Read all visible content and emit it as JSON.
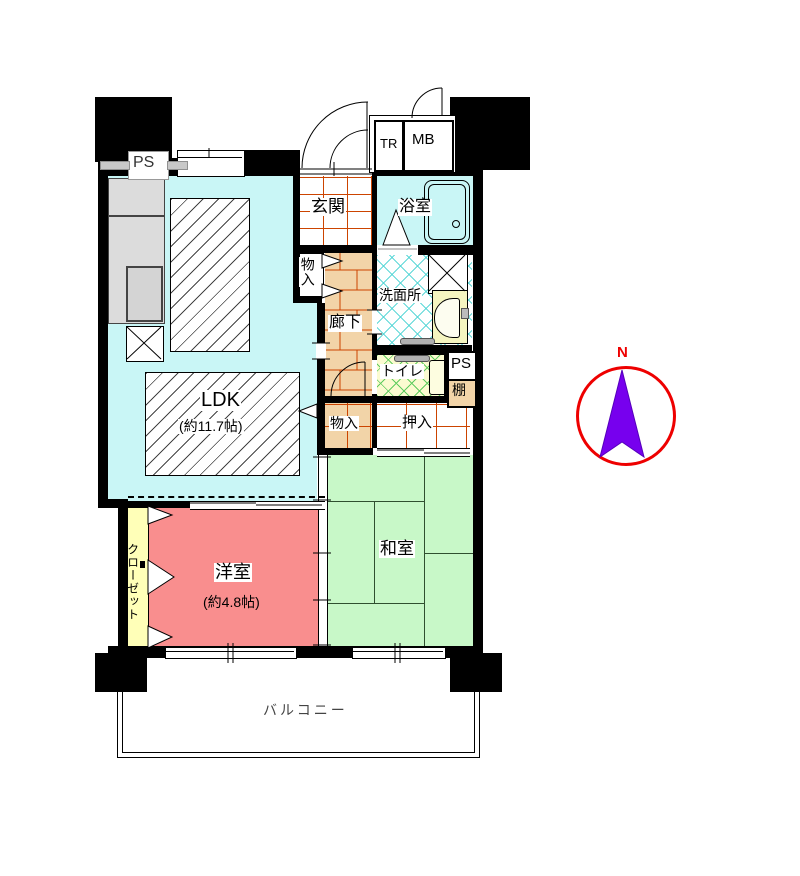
{
  "plan": {
    "rooms": {
      "ldk": {
        "label": "LDK",
        "size": "(約11.7帖)",
        "color": "#C9F6F6"
      },
      "western": {
        "label": "洋室",
        "size": "(約4.8帖)",
        "color": "#F98E8E"
      },
      "japanese": {
        "label": "和室",
        "color": "#C8F8C8"
      },
      "genkan": {
        "label": "玄関",
        "grid_color": "#CC4400"
      },
      "bathroom": {
        "label": "浴室",
        "color": "#C9F6F6"
      },
      "washroom": {
        "label": "洗面所",
        "crosshatch_color": "#5FD8D8"
      },
      "hallway": {
        "label": "廊下",
        "color": "#F2D4A8",
        "brick_line_color": "#CC4400"
      },
      "toilet": {
        "label": "トイレ",
        "color": "#FBFBD0",
        "crosshatch_color": "#5FCC5F"
      },
      "closet": {
        "label": "クローゼット",
        "color": "#FFFFB8"
      },
      "storage_hall": {
        "label": "物入"
      },
      "storage_ldk": {
        "label": "物入"
      },
      "oshiire": {
        "label": "押入"
      },
      "shelf": {
        "label": "棚",
        "color": "#F2D4A8"
      },
      "balcony": {
        "label": "バルコニー"
      }
    },
    "annotations": {
      "ps_top": "PS",
      "ps_mid": "PS",
      "tr": "TR",
      "mb": "MB",
      "north": "N"
    },
    "compass": {
      "ring_color": "#EE0000",
      "arrow_color": "#7700EE"
    }
  }
}
